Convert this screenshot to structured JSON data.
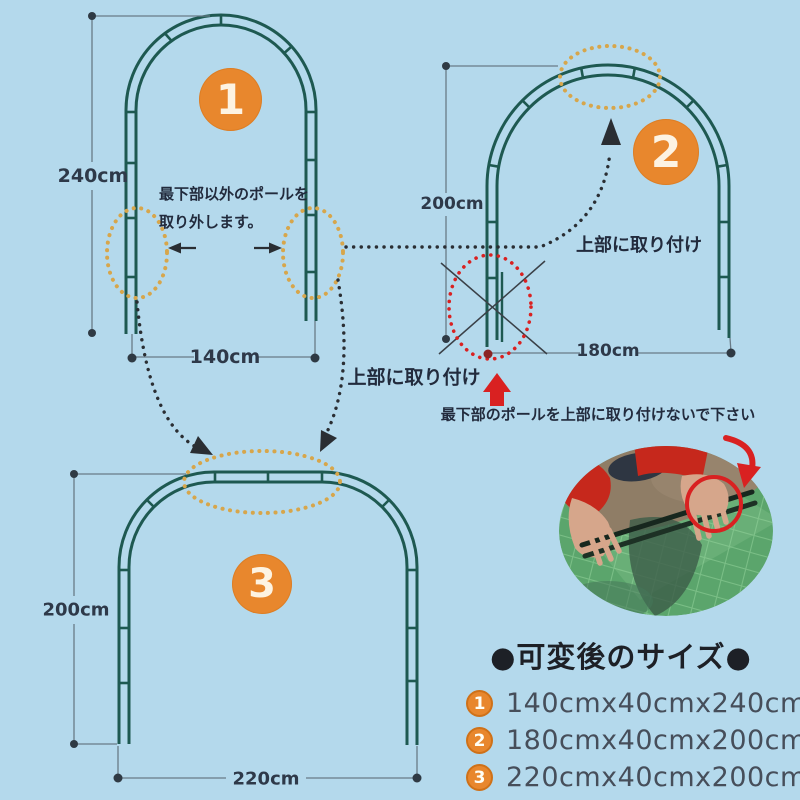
{
  "colors": {
    "background": "#b4d9ec",
    "arch_teal": "#1e5951",
    "accent_orange": "#e8872d",
    "highlight_tan": "#d7a64b",
    "warning_red": "#d92121",
    "text_dark": "#222b3d"
  },
  "arch1": {
    "badge": "1",
    "height_label": "240cm",
    "width_label": "140cm",
    "note_line1": "最下部以外のポールを",
    "note_line2": "取り外します。"
  },
  "arch2": {
    "badge": "2",
    "height_label": "200cm",
    "width_label": "180cm",
    "attach_label": "上部に取り付け",
    "warning": "最下部のポールを上部に取り付けないで下さい"
  },
  "arch3": {
    "badge": "3",
    "height_label": "200cm",
    "width_label": "220cm",
    "attach_label": "上部に取り付け"
  },
  "sizes": {
    "heading": "●可変後のサイズ●",
    "items": [
      {
        "num": "1",
        "dimensions": "140cmx40cmx240cm"
      },
      {
        "num": "2",
        "dimensions": "180cmx40cmx200cm"
      },
      {
        "num": "3",
        "dimensions": "220cmx40cmx200cm"
      }
    ]
  }
}
